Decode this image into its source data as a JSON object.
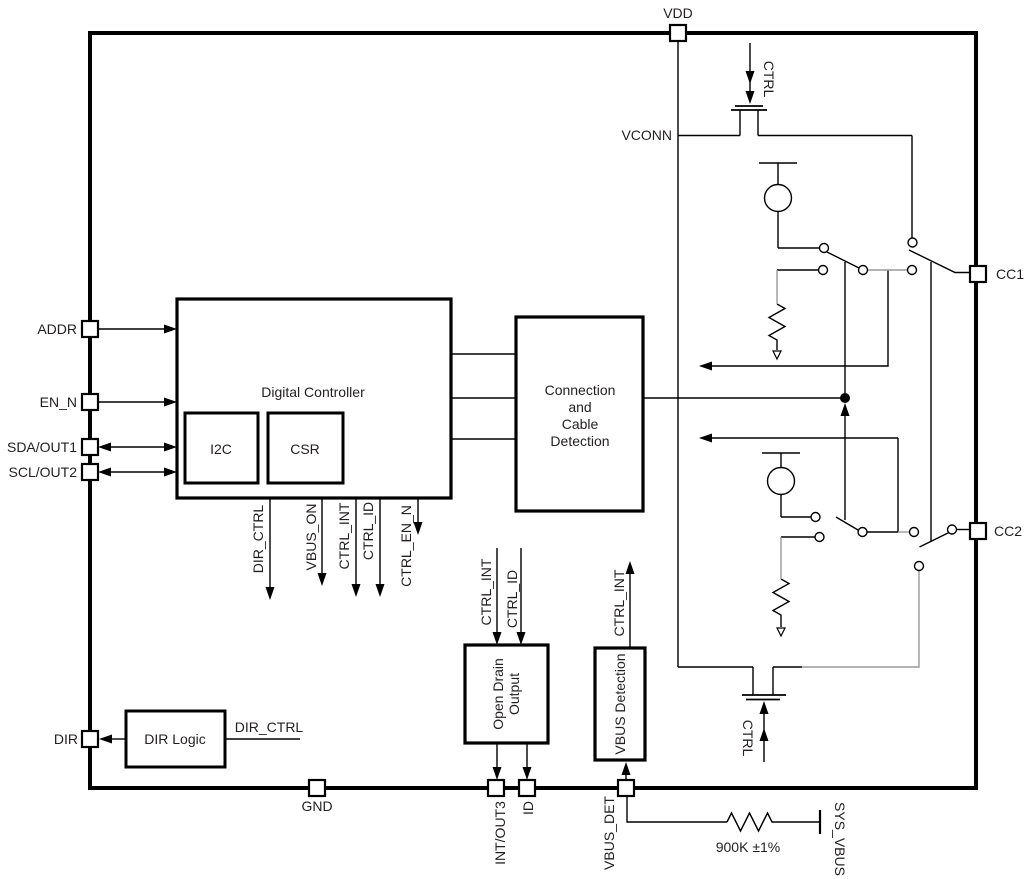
{
  "diagram": {
    "pins": {
      "vdd": "VDD",
      "addr": "ADDR",
      "en_n": "EN_N",
      "sda_out1": "SDA/OUT1",
      "scl_out2": "SCL/OUT2",
      "dir": "DIR",
      "gnd": "GND",
      "int_out3": "INT/OUT3",
      "id": "ID",
      "vbus_det": "VBUS_DET",
      "cc1": "CC1",
      "cc2": "CC2"
    },
    "blocks": {
      "digital_controller": "Digital Controller",
      "i2c": "I2C",
      "csr": "CSR",
      "connection_line1": "Connection",
      "connection_line2": "and",
      "connection_line3": "Cable",
      "connection_line4": "Detection",
      "open_drain_line1": "Open Drain",
      "open_drain_line2": "Output",
      "vbus_detection": "VBUS Detection",
      "dir_logic": "DIR Logic"
    },
    "signals": {
      "dir_ctrl": "DIR_CTRL",
      "vbus_on": "VBUS_ON",
      "ctrl_int": "CTRL_INT",
      "ctrl_id": "CTRL_ID",
      "ctrl_en_n": "CTRL_EN_N",
      "ctrl": "CTRL",
      "vconn": "VCONN",
      "sys_vbus": "SYS_VBUS"
    },
    "annotations": {
      "resistor_value": "900K ±1%"
    },
    "colors": {
      "line": "#000000",
      "gray_line": "#9a9a9a",
      "text": "#231f20",
      "background": "#ffffff"
    }
  }
}
